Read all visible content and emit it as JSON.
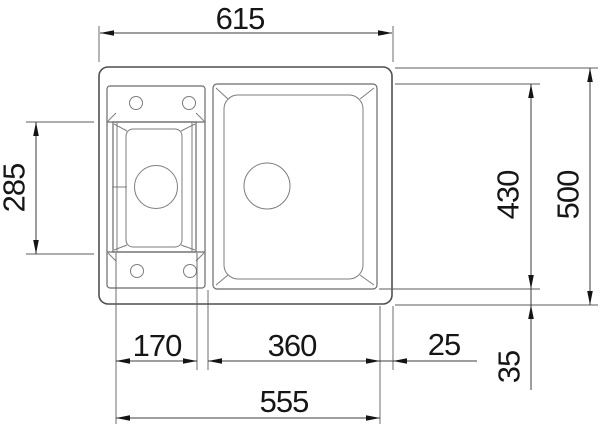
{
  "drawing": {
    "description": "Top-view technical drawing of a kitchen sink with one large bowl, one small bowl and tap ledges",
    "background_color": "#ffffff",
    "line_color": "#5c5c5c",
    "dimension_ink_color": "#141414"
  },
  "dimensions": {
    "overall_width": "615",
    "overall_depth": "500",
    "bowl_depth": "430",
    "small_bowl_opening_depth": "285",
    "small_bowl_width": "170",
    "large_bowl_width": "360",
    "right_edge_gap": "25",
    "bottom_span": "555",
    "bottom_edge_gap": "35"
  }
}
